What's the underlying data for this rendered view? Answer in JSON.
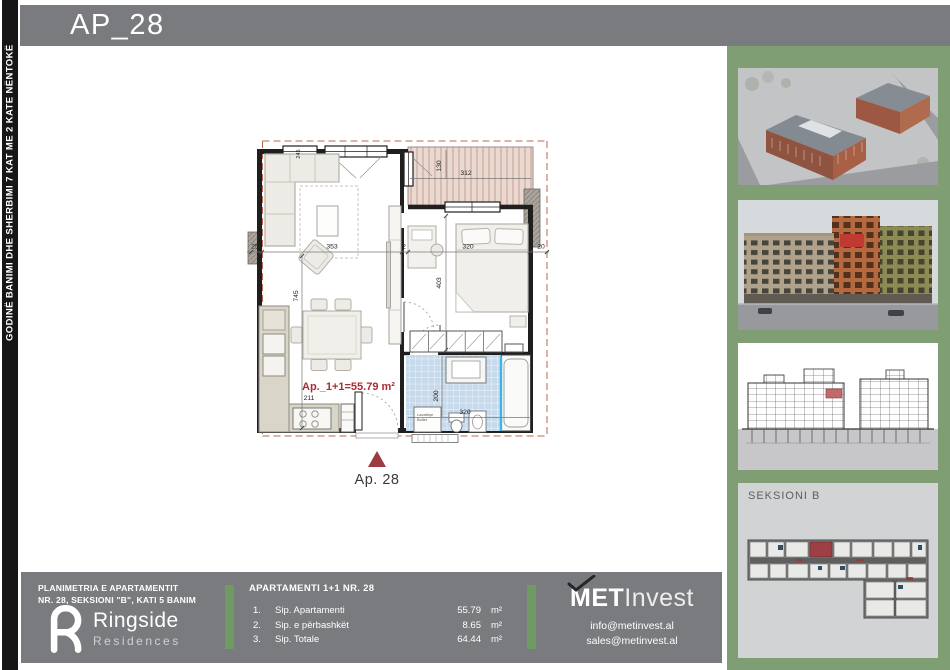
{
  "header": {
    "title": "AP_28"
  },
  "spine": {
    "text": "GODINË BANIMI DHE SHERBIMI 7 KAT ME 2 KATE NËNTOKË"
  },
  "plan": {
    "area_label": "Ap._1+1=55.79 m²",
    "marker_label": "Ap. 28",
    "washer_line1": "Lavatriçe",
    "washer_line2": "Boiler",
    "dims": {
      "window_top": "245",
      "balcony_depth": "130",
      "balcony_width": "312",
      "seg_a": "25",
      "seg_b": "353",
      "seg_c": "2",
      "seg_d": "320",
      "seg_e": "20",
      "living_depth": "745",
      "bedroom_depth": "403",
      "kitchen_len": "211",
      "bath_depth": "200",
      "bath_width": "320"
    }
  },
  "sidebar": {
    "keyplan_label": "SEKSIONI B"
  },
  "footer": {
    "left_title_line1": "PLANIMETRIA E APARTAMENTIT",
    "left_title_line2": "NR. 28, SEKSIONI \"B\", KATI 5  BANIM",
    "brand": {
      "name": "Ringside",
      "sub": "Residences"
    },
    "table": {
      "title": "APARTAMENTI 1+1 NR. 28",
      "rows": [
        {
          "num": "1.",
          "label": "Sip. Apartamenti",
          "value": "55.79",
          "unit": "m²"
        },
        {
          "num": "2.",
          "label": "Sip. e përbashkët",
          "value": "8.65",
          "unit": "m²"
        },
        {
          "num": "3.",
          "label": "Sip. Totale",
          "value": "64.44",
          "unit": "m²"
        }
      ]
    },
    "developer": {
      "logo_bold": "MET",
      "logo_light": "Invest",
      "email1": "info@metinvest.al",
      "email2": "sales@metinvest.al"
    }
  },
  "colors": {
    "header_gray": "#7a7b7e",
    "strip_green": "#7f9e74",
    "divider_green": "#6f9a64",
    "accent_red": "#9c3c42",
    "tile_blue": "#c7daec",
    "deck_tan": "#ead9d1"
  }
}
